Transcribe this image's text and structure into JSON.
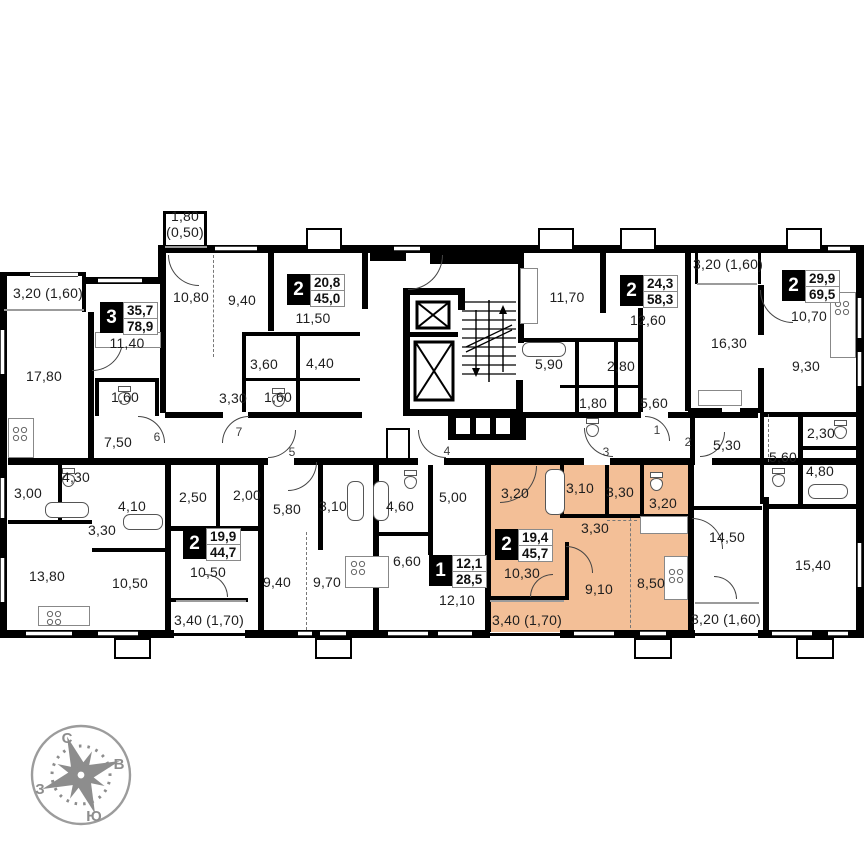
{
  "plan": {
    "highlight_color": "#f3bf97",
    "wall_color": "#000000",
    "apartments": [
      {
        "rooms": "3",
        "living": "35,7",
        "total": "78,9",
        "x": 100,
        "y": 302,
        "highlighted": false
      },
      {
        "rooms": "2",
        "living": "20,8",
        "total": "45,0",
        "x": 287,
        "y": 274,
        "highlighted": false
      },
      {
        "rooms": "2",
        "living": "24,3",
        "total": "58,3",
        "x": 620,
        "y": 275,
        "highlighted": false
      },
      {
        "rooms": "2",
        "living": "29,9",
        "total": "69,5",
        "x": 782,
        "y": 270,
        "highlighted": false
      },
      {
        "rooms": "2",
        "living": "19,9",
        "total": "44,7",
        "x": 183,
        "y": 528,
        "highlighted": false
      },
      {
        "rooms": "1",
        "living": "12,1",
        "total": "28,5",
        "x": 429,
        "y": 555,
        "highlighted": false
      },
      {
        "rooms": "2",
        "living": "19,4",
        "total": "45,7",
        "x": 495,
        "y": 529,
        "highlighted": true
      }
    ],
    "room_labels": [
      {
        "t": "3,20 (1,60)",
        "x": 48,
        "y": 293
      },
      {
        "t": "17,80",
        "x": 44,
        "y": 376
      },
      {
        "t": "11,40",
        "x": 127,
        "y": 343
      },
      {
        "t": "1,60",
        "x": 125,
        "y": 397
      },
      {
        "t": "7,50",
        "x": 118,
        "y": 442
      },
      {
        "t": "1,80",
        "t2": "(0,50)",
        "x": 185,
        "y": 224
      },
      {
        "t": "10,80",
        "x": 191,
        "y": 297
      },
      {
        "t": "9,40",
        "x": 242,
        "y": 300
      },
      {
        "t": "11,50",
        "x": 313,
        "y": 318
      },
      {
        "t": "3,60",
        "x": 264,
        "y": 364
      },
      {
        "t": "4,40",
        "x": 320,
        "y": 363
      },
      {
        "t": "3,30",
        "x": 233,
        "y": 398
      },
      {
        "t": "1,60",
        "x": 278,
        "y": 397
      },
      {
        "t": "11,70",
        "x": 567,
        "y": 297
      },
      {
        "t": "5,90",
        "x": 549,
        "y": 364
      },
      {
        "t": "2,80",
        "x": 621,
        "y": 366
      },
      {
        "t": "1,80",
        "x": 593,
        "y": 403
      },
      {
        "t": "12,60",
        "x": 648,
        "y": 320
      },
      {
        "t": "5,60",
        "x": 654,
        "y": 403
      },
      {
        "t": "3,20 (1,60)",
        "x": 728,
        "y": 264
      },
      {
        "t": "16,30",
        "x": 729,
        "y": 343
      },
      {
        "t": "10,70",
        "x": 809,
        "y": 316
      },
      {
        "t": "9,30",
        "x": 806,
        "y": 366
      },
      {
        "t": "2,30",
        "x": 821,
        "y": 433
      },
      {
        "t": "5,60",
        "x": 783,
        "y": 457
      },
      {
        "t": "5,30",
        "x": 727,
        "y": 445
      },
      {
        "t": "4,80",
        "x": 820,
        "y": 471
      },
      {
        "t": "14,50",
        "x": 727,
        "y": 537
      },
      {
        "t": "15,40",
        "x": 813,
        "y": 565
      },
      {
        "t": "3,20 (1,60)",
        "x": 726,
        "y": 619
      },
      {
        "t": "3,00",
        "x": 28,
        "y": 493
      },
      {
        "t": "4,30",
        "x": 76,
        "y": 477
      },
      {
        "t": "4,10",
        "x": 132,
        "y": 506
      },
      {
        "t": "3,30",
        "x": 102,
        "y": 530
      },
      {
        "t": "13,80",
        "x": 47,
        "y": 576
      },
      {
        "t": "10,50",
        "x": 130,
        "y": 583
      },
      {
        "t": "2,50",
        "x": 193,
        "y": 497
      },
      {
        "t": "2,00",
        "x": 247,
        "y": 495
      },
      {
        "t": "10,50",
        "x": 208,
        "y": 572
      },
      {
        "t": "3,40 (1,70)",
        "x": 209,
        "y": 620
      },
      {
        "t": "5,80",
        "x": 287,
        "y": 509
      },
      {
        "t": "3,10",
        "x": 333,
        "y": 506
      },
      {
        "t": "9,40",
        "x": 277,
        "y": 582
      },
      {
        "t": "9,70",
        "x": 327,
        "y": 582
      },
      {
        "t": "4,60",
        "x": 400,
        "y": 506
      },
      {
        "t": "6,60",
        "x": 407,
        "y": 561
      },
      {
        "t": "5,00",
        "x": 453,
        "y": 497
      },
      {
        "t": "12,10",
        "x": 457,
        "y": 600
      },
      {
        "t": "3,20",
        "x": 515,
        "y": 493
      },
      {
        "t": "3,10",
        "x": 580,
        "y": 488
      },
      {
        "t": "3,30",
        "x": 620,
        "y": 492
      },
      {
        "t": "3,20",
        "x": 663,
        "y": 503
      },
      {
        "t": "3,30",
        "x": 595,
        "y": 528
      },
      {
        "t": "10,30",
        "x": 522,
        "y": 573
      },
      {
        "t": "9,10",
        "x": 599,
        "y": 589
      },
      {
        "t": "8,50",
        "x": 651,
        "y": 583
      },
      {
        "t": "3,40 (1,70)",
        "x": 527,
        "y": 620
      }
    ],
    "entrance_numbers": [
      {
        "n": "6",
        "x": 157,
        "y": 437
      },
      {
        "n": "7",
        "x": 239,
        "y": 432
      },
      {
        "n": "5",
        "x": 292,
        "y": 452
      },
      {
        "n": "4",
        "x": 447,
        "y": 451
      },
      {
        "n": "3",
        "x": 606,
        "y": 452
      },
      {
        "n": "1",
        "x": 657,
        "y": 430
      },
      {
        "n": "2",
        "x": 688,
        "y": 442
      }
    ],
    "compass": {
      "north": "С",
      "south": "Ю",
      "east": "В",
      "west": "З"
    }
  }
}
